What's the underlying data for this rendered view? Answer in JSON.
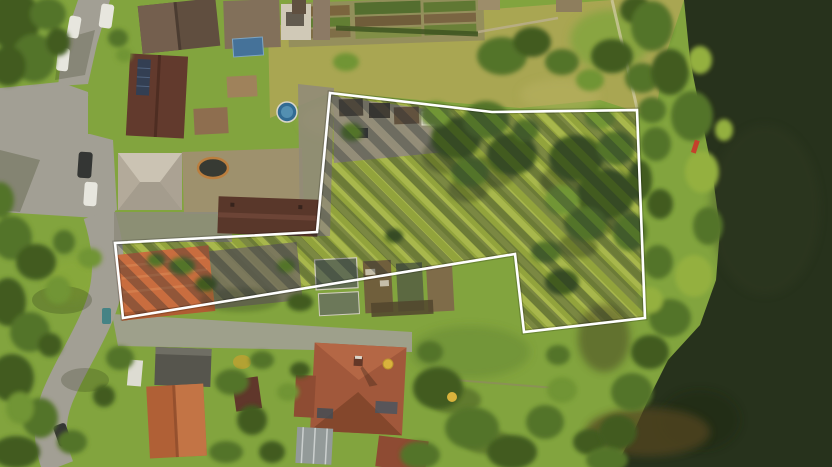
{
  "image": {
    "kind": "aerial-drone-photograph",
    "description": "Top-down aerial photo of riverside residential plots; an L-shaped parcel is highlighted with a white outline and dark diagonal hatching over its lawn, gardens and outbuildings. A street with parked cars runs along the left, houses with red and gray roofs surround the parcel, and a dark river borders the tree-lined right edge."
  },
  "colors": {
    "boundary": "#ffffff",
    "hatch": "#1b2430",
    "water": "#1f2b18",
    "water_shallow": "#4e401f",
    "lawn_parcel": "#9aab40",
    "lawn_outer": "#7da23c",
    "field_dry": "#a9a452",
    "tree_dark": "#3a571f",
    "tree_mid": "#4e7026",
    "tree_light": "#6c9231",
    "tree_bright": "#90ae3d",
    "road": "#9f9d95",
    "paving": "#968e7e",
    "roof_dark_brown": "#5a483d",
    "roof_maroon": "#533027",
    "roof_orange": "#c7693d",
    "roof_terracotta": "#9e5339",
    "roof_light_gray": "#b5ada1",
    "solar_panel": "#2b3952",
    "pool_blue": "#2a6794",
    "car_white": "#e6e6e2",
    "car_dark": "#2c2f31",
    "canoe_red": "#c23a28",
    "shadow": "#1e2b0c"
  },
  "property": {
    "outline_points": "330,93 492,112 637,110 645,318 524,332 515,254 123,318 115,243 317,232",
    "outline_width": 2.6,
    "hatch_opacity": 0.32
  }
}
